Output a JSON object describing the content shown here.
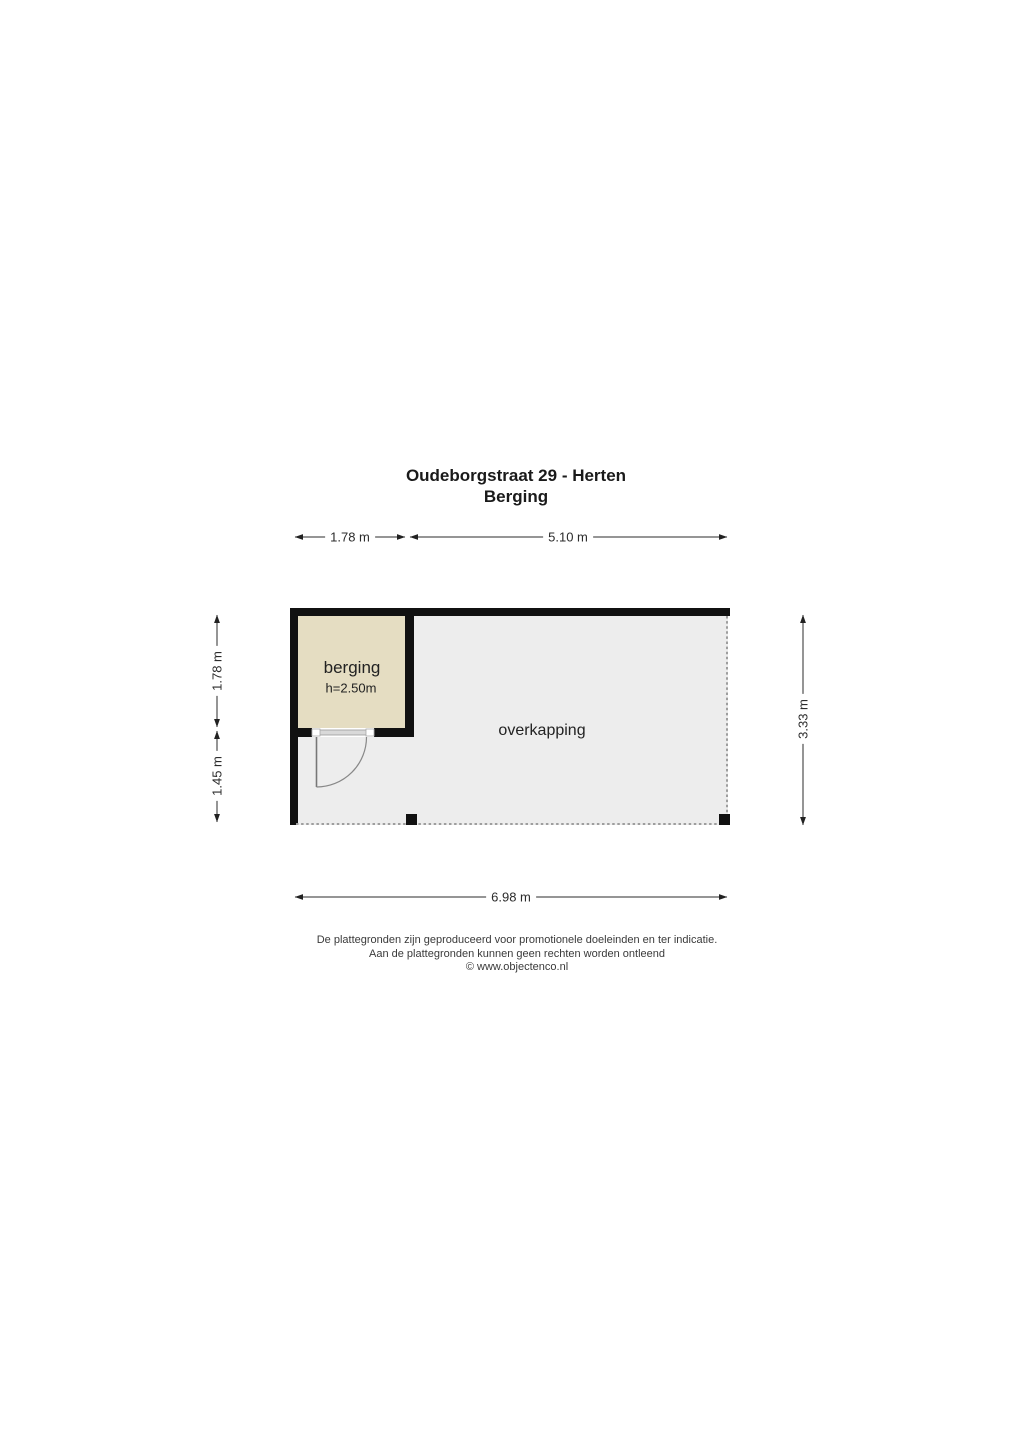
{
  "title": {
    "line1": "Oudeborgstraat 29 - Herten",
    "line2": "Berging"
  },
  "rooms": {
    "berging": {
      "label": "berging",
      "height_note": "h=2.50m"
    },
    "overkapping": {
      "label": "overkapping"
    }
  },
  "dimensions": {
    "top": [
      {
        "label": "1.78 m"
      },
      {
        "label": "5.10 m"
      }
    ],
    "left": [
      {
        "label": "1.78 m"
      },
      {
        "label": "1.45 m"
      }
    ],
    "right": [
      {
        "label": "3.33 m"
      }
    ],
    "bottom": [
      {
        "label": "6.98 m"
      }
    ]
  },
  "footer": {
    "line1": "De plattegronden zijn geproduceerd voor promotionele doeleinden en ter indicatie.",
    "line2": "Aan de plattegronden kunnen geen rechten worden ontleend",
    "line3": "© www.objectenco.nl"
  },
  "colors": {
    "wall": "#111111",
    "berging_fill": "#e5ddc2",
    "overkapping_fill": "#ededed",
    "dotted_edge": "#9e9e9e",
    "dimension_line": "#2b2b2b"
  }
}
